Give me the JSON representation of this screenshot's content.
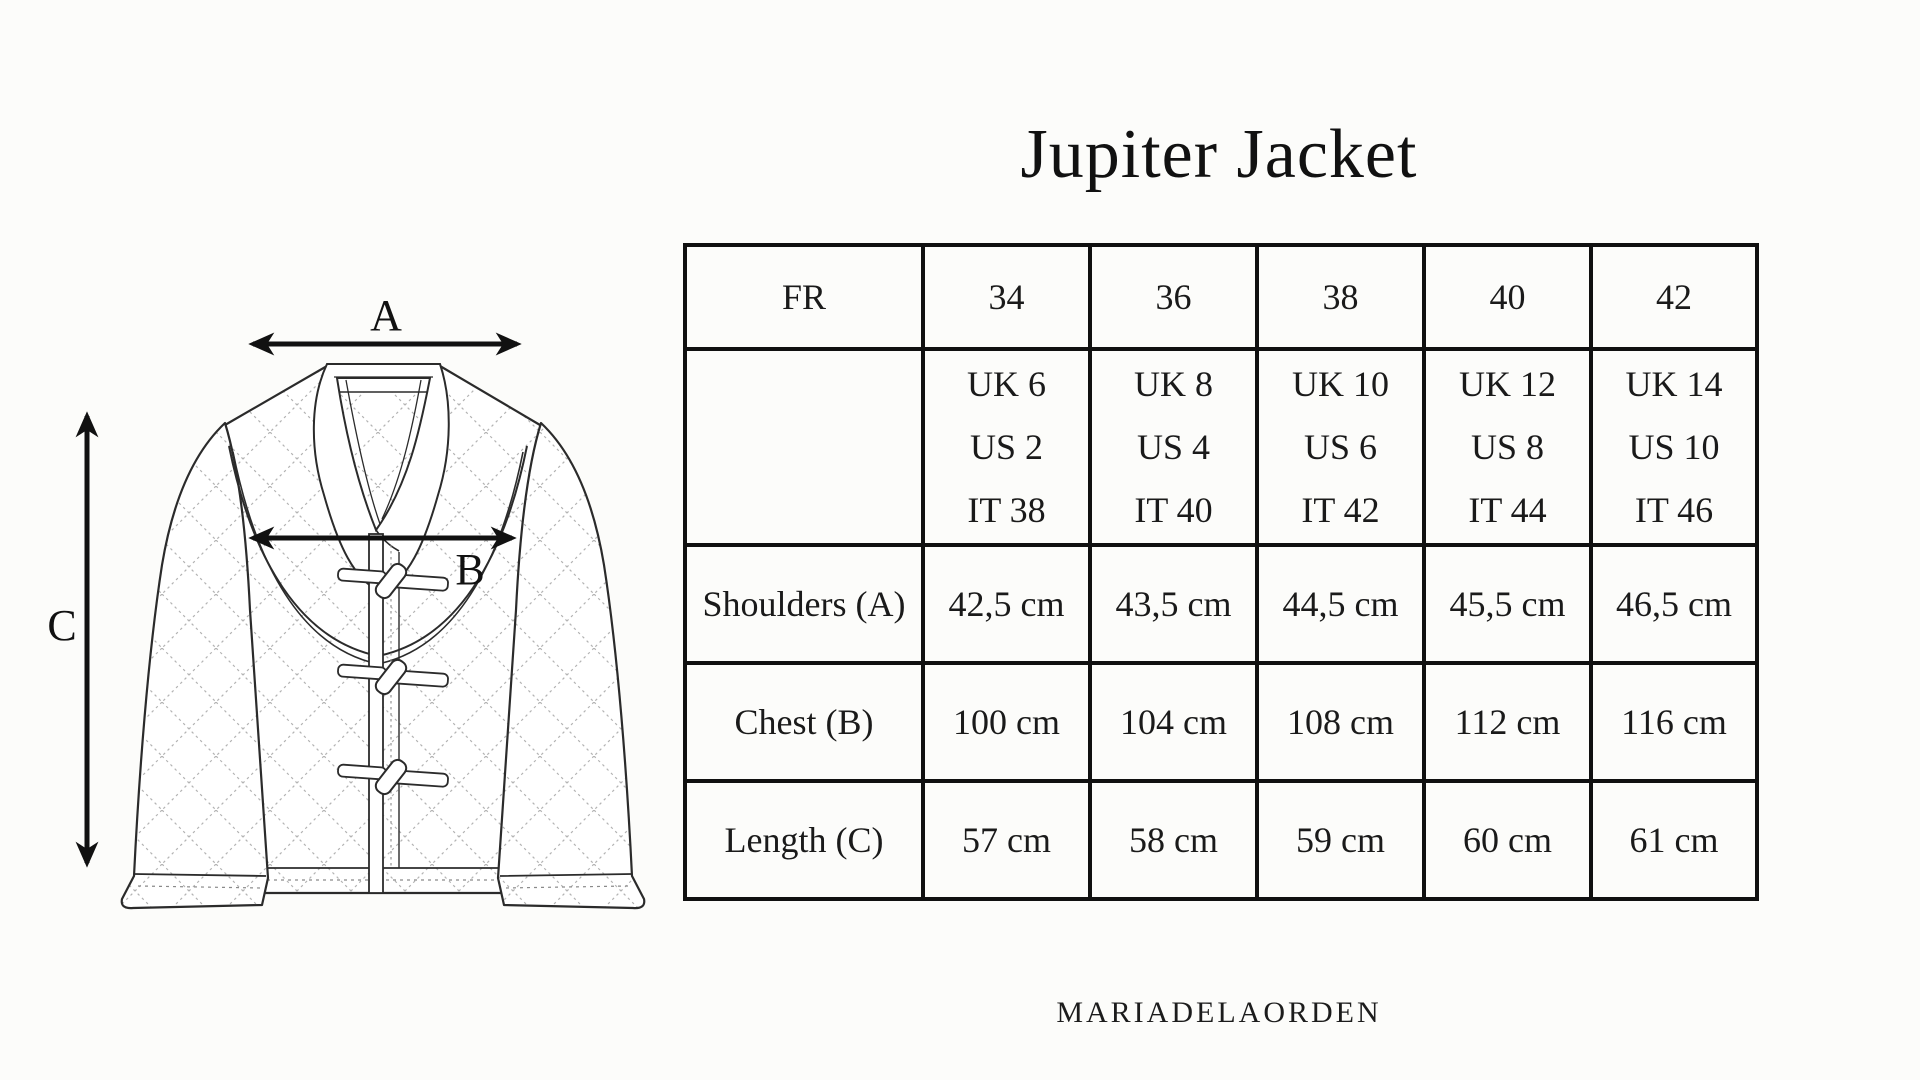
{
  "page": {
    "background": "#fcfcfa",
    "ink": "#141414",
    "accent_green": "#7e8c66",
    "table_border": "#101010"
  },
  "title": "Jupiter Jacket",
  "brand": "MARIADELAORDEN",
  "diagram": {
    "description": "quilted-jacket-technical-flat",
    "labels": {
      "a": "A",
      "b": "B",
      "c": "C"
    }
  },
  "size_table": {
    "header_label": "FR",
    "sizes": [
      "34",
      "36",
      "38",
      "40",
      "42"
    ],
    "conversions": [
      {
        "uk": "UK 6",
        "us": "US 2",
        "it": "IT 38"
      },
      {
        "uk": "UK 8",
        "us": "US 4",
        "it": "IT 40"
      },
      {
        "uk": "UK 10",
        "us": "US 6",
        "it": "IT 42"
      },
      {
        "uk": "UK 12",
        "us": "US 8",
        "it": "IT 44"
      },
      {
        "uk": "UK 14",
        "us": "US 10",
        "it": "IT 46"
      }
    ],
    "measurements": [
      {
        "label": "Shoulders (A)",
        "values": [
          "42,5 cm",
          "43,5 cm",
          "44,5 cm",
          "45,5 cm",
          "46,5 cm"
        ]
      },
      {
        "label": "Chest (B)",
        "values": [
          "100 cm",
          "104 cm",
          "108 cm",
          "112 cm",
          "116 cm"
        ]
      },
      {
        "label": "Length (C)",
        "values": [
          "57 cm",
          "58 cm",
          "59 cm",
          "60 cm",
          "61 cm"
        ]
      }
    ]
  }
}
